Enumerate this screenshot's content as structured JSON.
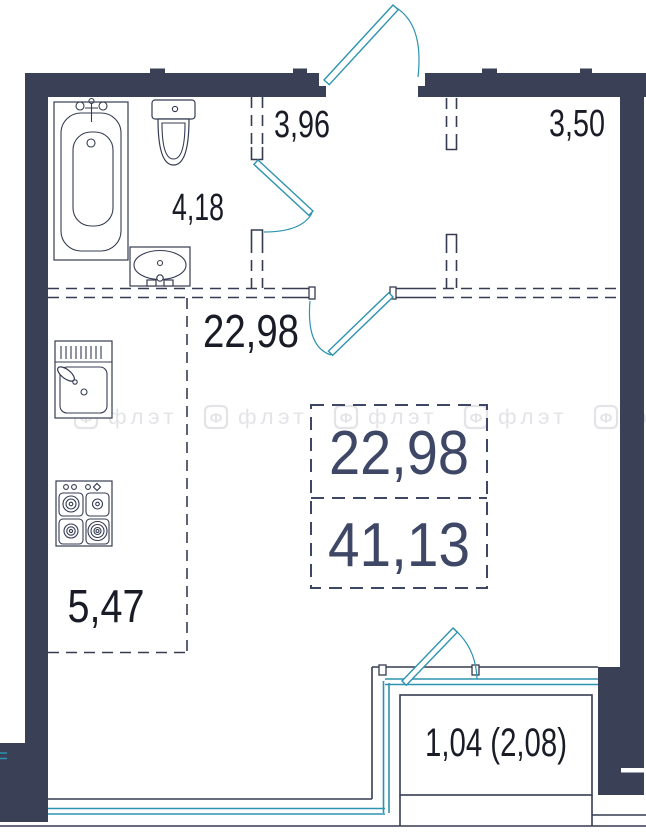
{
  "title": "apartment-floor-plan",
  "colors": {
    "wall": "#3a4157",
    "line": "#353c52",
    "accent": "#2e93b0",
    "label": "#191c26",
    "summary": "#3e4766",
    "watermark": "#e4e4e8",
    "bg": "#ffffff"
  },
  "watermark": {
    "icon": "Ф",
    "text": "флэт"
  },
  "rooms": [
    {
      "name": "hallway",
      "area": "3,96"
    },
    {
      "name": "closet",
      "area": "3,50"
    },
    {
      "name": "bathroom",
      "area": "4,18"
    },
    {
      "name": "living-room",
      "area": "22,98"
    },
    {
      "name": "kitchen",
      "area": "5,47"
    },
    {
      "name": "balcony",
      "area": "1,04 (2,08)"
    }
  ],
  "summary": {
    "living_area": "22,98",
    "total_area": "41,13"
  }
}
